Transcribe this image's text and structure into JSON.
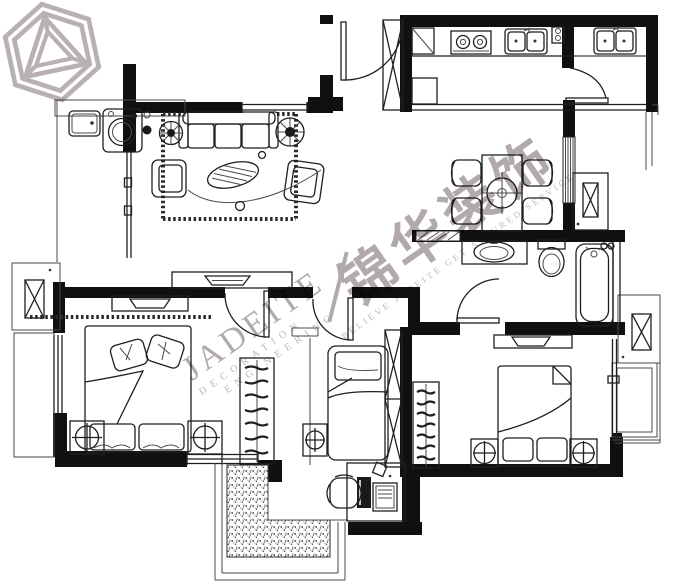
{
  "watermark": {
    "brand_cn": "锦华装饰",
    "brand_en": "JADEITE",
    "tagline_line1": "DECORATION",
    "tagline_line2": "ENGINEERING",
    "slogan": "BELIEVE JADEITE GET ASSURED SERVICE",
    "color": "#b2aaaa",
    "logo_icon": "jadeite-hexagon-logo"
  },
  "plan": {
    "background": "#ffffff",
    "wall_color": "#101010",
    "line_color": "#1f1f1f",
    "fixtures": [
      "entry-door",
      "shoe-cabinet",
      "kitchen-counter",
      "gas-stove",
      "kitchen-sink",
      "secondary-sink",
      "kitchen-cabinets",
      "dining-table",
      "dining-chair",
      "flue-duct",
      "sofa",
      "coffee-table",
      "armchair",
      "lounge-chair",
      "potted-plant",
      "tv-cabinet",
      "area-rug",
      "laundry-sink",
      "washing-machine",
      "sliding-door",
      "bathroom-vanity",
      "toilet",
      "bathtub",
      "master-bed",
      "nightstand-lamp",
      "dresser",
      "clothes-rack",
      "bay-window",
      "ac-platform",
      "single-bed",
      "wardrobe",
      "desk",
      "computer-monitor",
      "computer-tower",
      "desk-chair",
      "double-bed",
      "balcony",
      "stippled-floor",
      "window"
    ]
  }
}
